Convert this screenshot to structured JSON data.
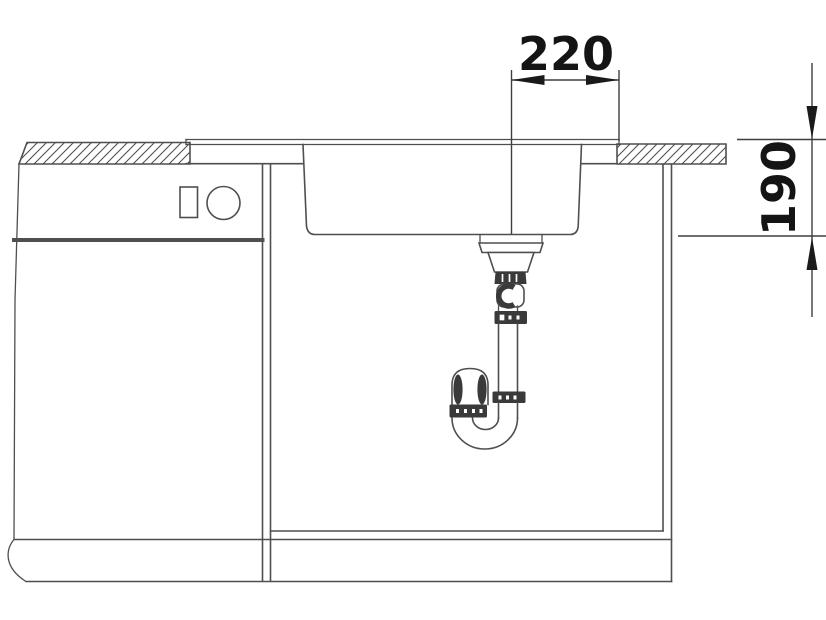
{
  "dimensions": {
    "horizontal": {
      "label": "220"
    },
    "vertical": {
      "label": "190"
    }
  },
  "colors": {
    "background": "#ffffff",
    "line": "#4f4f4f",
    "fitting_dark": "#3a3a3a",
    "dimension_text": "#141414"
  },
  "icons": [
    {
      "name": "appliance-display-icon",
      "shape": "rectangle"
    },
    {
      "name": "appliance-knob-icon",
      "shape": "circle"
    }
  ]
}
